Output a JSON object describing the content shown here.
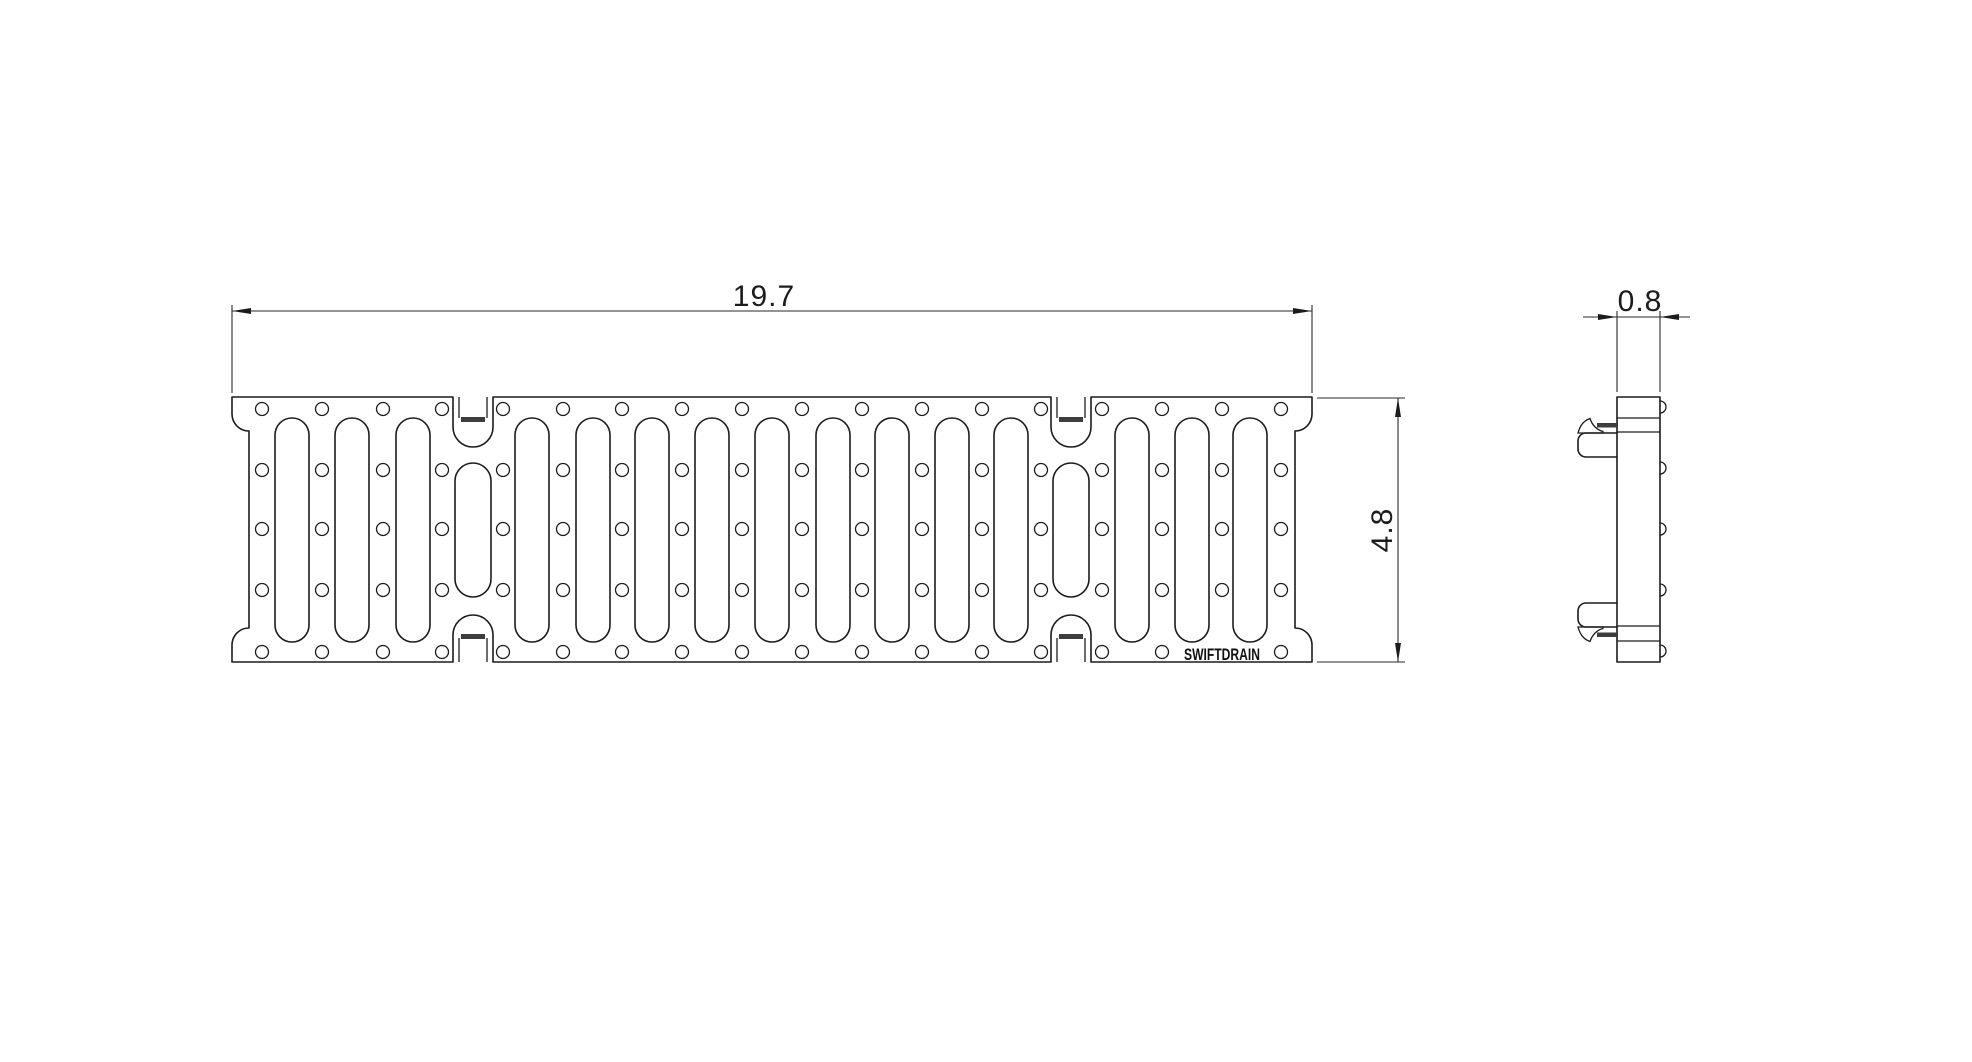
{
  "meta": {
    "background_color": "#ffffff",
    "line_color": "#1c1c1c",
    "lockbar_color": "#3d3d3d",
    "drawing_type": "trench-drain-grate-technical-drawing"
  },
  "brand": {
    "label": "SWIFTDRAIN"
  },
  "dimensions": {
    "width": {
      "value": "19.7"
    },
    "height": {
      "value": "4.8"
    },
    "thickness": {
      "value": "0.8"
    }
  },
  "drawing": {
    "plan": {
      "left": 232,
      "right": 1312,
      "top": 397,
      "bottom": 662,
      "end_fillet_radius": 17,
      "notch_centers": [
        473,
        1071
      ],
      "notch": {
        "half_width": 20,
        "top_wall_depth": 30,
        "bottom_wall_depth": 27,
        "arc_radius": 20,
        "inner_half_width": 14,
        "inner_depth": 21,
        "bar_half_width": 12,
        "bar_thickness": 5
      },
      "long_slots": {
        "centers": [
          292,
          352,
          413,
          532,
          593,
          652,
          712,
          772,
          833,
          892,
          952,
          1011,
          1132,
          1192,
          1250
        ],
        "top": 418,
        "bottom": 642,
        "width": 34
      },
      "short_slots": {
        "centers": [
          473,
          1071
        ],
        "top": 463,
        "bottom": 597,
        "width": 36
      },
      "holes": {
        "columns": [
          262,
          322,
          383,
          442,
          503,
          563,
          622,
          682,
          742,
          802,
          862,
          922,
          982,
          1041,
          1102,
          1162,
          1222,
          1281
        ],
        "rows": [
          409,
          470,
          529,
          590,
          652
        ],
        "radius": 6.5,
        "skip": [
          [
            1222,
            652
          ]
        ]
      },
      "brand_pos": {
        "x": 1222,
        "y": 660,
        "text_length": 76
      }
    },
    "side": {
      "left": 1617,
      "right": 1660,
      "top": 397,
      "bottom": 662,
      "section_lines": [
        418,
        432,
        626,
        641
      ],
      "bump_ys": [
        407,
        468,
        529,
        590,
        651
      ],
      "bump_radius": 6,
      "clip_left": 1578,
      "clip_corner_radius": 8,
      "top_clip_rect": [
        433,
        457
      ],
      "bottom_clip_rect": [
        603,
        627
      ],
      "top_bar": [
        1597,
        423,
        21,
        4.5
      ],
      "bottom_bar": [
        1597,
        632.5,
        21,
        4.5
      ]
    },
    "dims": {
      "width": {
        "line_y": 311,
        "x1": 232,
        "x2": 1312,
        "ext_top": 305,
        "ext_bottom": 393
      },
      "height": {
        "line_x": 1398,
        "y1": 398,
        "y2": 662,
        "ext_x1": 1317,
        "ext_x2": 1405
      },
      "thickness": {
        "line_y": 317,
        "x1": 1583,
        "x2": 1690,
        "e1": 1617,
        "e2": 1660,
        "ext_top": 311,
        "ext_bottom": 392
      },
      "arrow_length": 19,
      "arrow_half_width": 3
    }
  }
}
